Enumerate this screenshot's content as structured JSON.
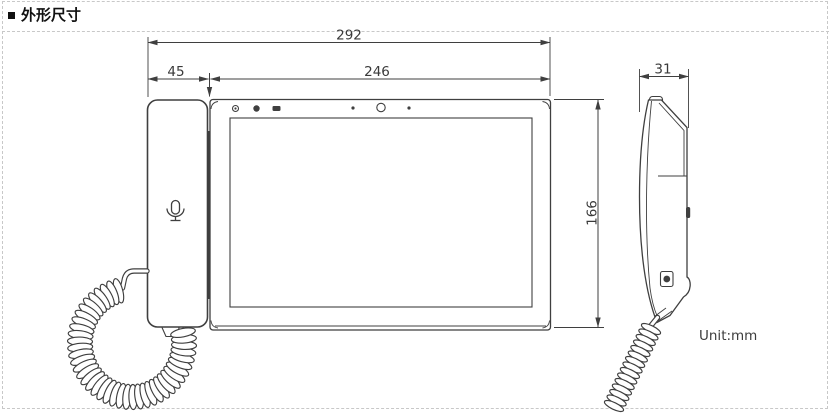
{
  "title": {
    "bullet_icon": "square-bullet-icon",
    "text": "外形尺寸"
  },
  "drawing": {
    "unit_label": "Unit:mm",
    "dimensions": {
      "overall_width_mm": "292",
      "handset_width_mm": "45",
      "panel_width_mm": "246",
      "panel_height_mm": "166",
      "depth_mm": "31"
    },
    "icons": {
      "handset": "microphone-icon",
      "bezel_left": [
        "indicator-led-icon",
        "indicator-led-icon",
        "ir-window-icon"
      ],
      "bezel_center": [
        "mic-hole-icon",
        "camera-lens-icon",
        "light-sensor-icon"
      ]
    }
  },
  "colors": {
    "line": "#3f3f3f",
    "dash": "#c8c8c8",
    "dim_text": "#3a3a3a",
    "title_text": "#111111",
    "unit_text": "#3c3c3c",
    "bg": "#ffffff"
  }
}
